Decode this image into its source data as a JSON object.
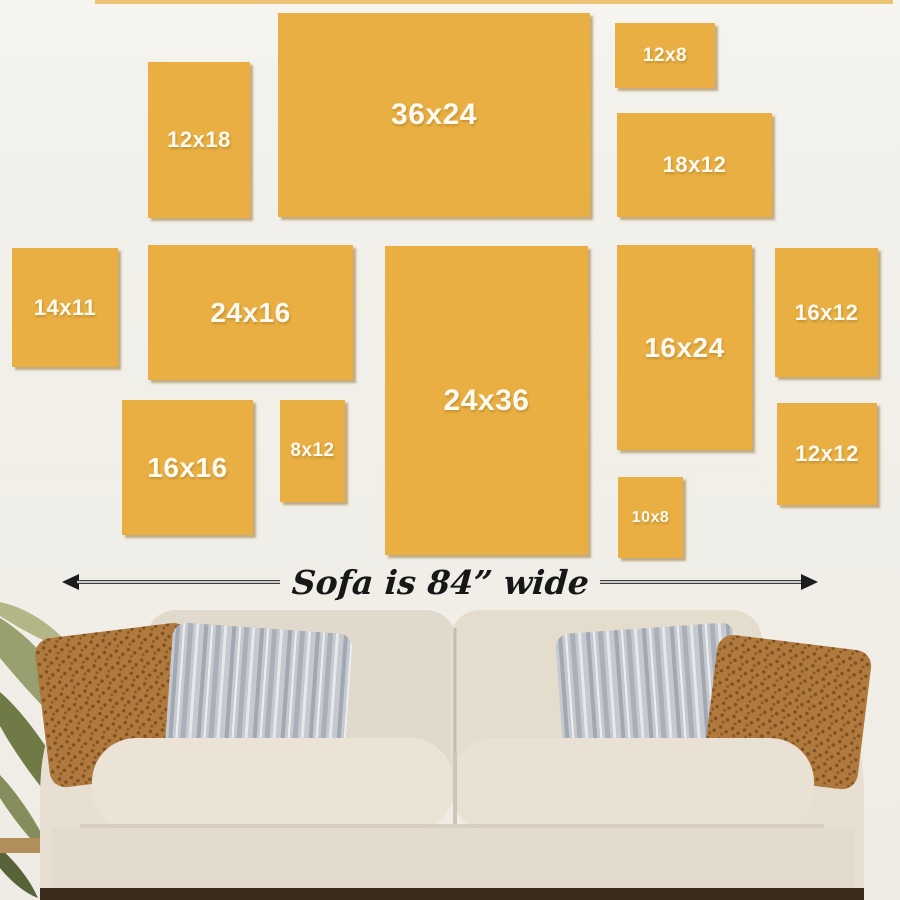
{
  "page": {
    "background_color": "#f1efe9",
    "canvas_color": "#e9af43",
    "label_color": "#fdfaf2",
    "arrow_color": "#1c1c1c"
  },
  "size_guide": {
    "canvases": [
      {
        "label": "12x18"
      },
      {
        "label": "36x24"
      },
      {
        "label": "12x8"
      },
      {
        "label": "18x12"
      },
      {
        "label": "14x11"
      },
      {
        "label": "24x16"
      },
      {
        "label": "24x36"
      },
      {
        "label": "16x24"
      },
      {
        "label": "16x12"
      },
      {
        "label": "16x16"
      },
      {
        "label": "8x12"
      },
      {
        "label": "12x12"
      },
      {
        "label": "10x8"
      }
    ],
    "sofa_width_label": "Sofa is 84” wide"
  }
}
